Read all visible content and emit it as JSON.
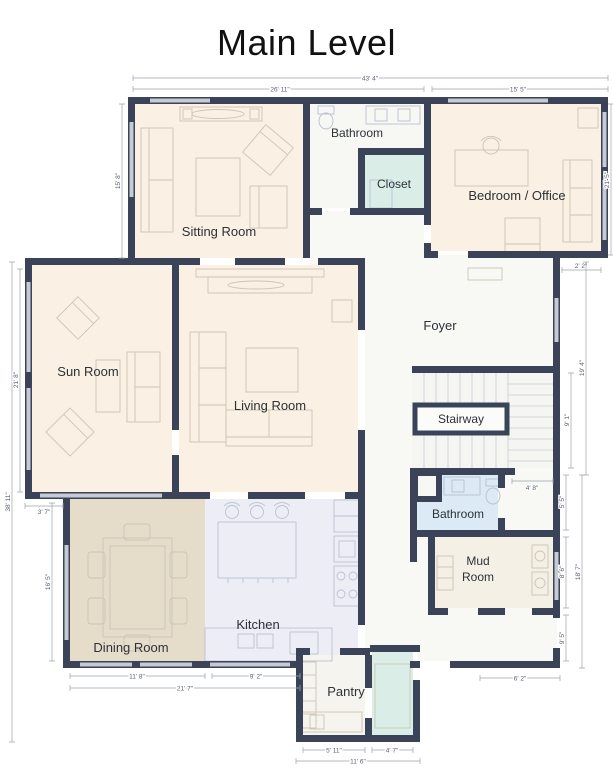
{
  "title": "Main Level",
  "colors": {
    "wall": "#3b4359",
    "room_cream": "#faf0e3",
    "dining_tan": "#e6dcca",
    "kitchen_lavender": "#edeef5",
    "bath_blue": "#dceaf6",
    "closet_teal": "#daeee7",
    "window_gray": "#c6cad2",
    "foyer_white": "#f8f8f5"
  },
  "rooms": {
    "sitting": {
      "label": "Sitting Room"
    },
    "bathroom_top": {
      "label": "Bathroom"
    },
    "closet": {
      "label": "Closet"
    },
    "bedroom_office": {
      "label": "Bedroom / Office"
    },
    "foyer": {
      "label": "Foyer"
    },
    "sun_room": {
      "label": "Sun Room"
    },
    "living_room": {
      "label": "Living Room"
    },
    "stairway": {
      "label": "Stairway"
    },
    "bathroom_lower": {
      "label": "Bathroom"
    },
    "mud_room": {
      "label": "Mud Room",
      "line1": "Mud",
      "line2": "Room"
    },
    "dining_room": {
      "label": "Dining Room"
    },
    "kitchen": {
      "label": "Kitchen"
    },
    "pantry": {
      "label": "Pantry"
    }
  },
  "dims": [
    {
      "label": "43' 4\""
    },
    {
      "label": "26' 11\""
    },
    {
      "label": "15' 5\""
    },
    {
      "label": "15' 8\""
    },
    {
      "label": "38' 11\""
    },
    {
      "label": "21' 8\""
    },
    {
      "label": "3' 7\""
    },
    {
      "label": "16' 5\""
    },
    {
      "label": "11' 8\""
    },
    {
      "label": "9' 2\""
    },
    {
      "label": "21' 7\""
    },
    {
      "label": "5' 11\""
    },
    {
      "label": "4' 7\""
    },
    {
      "label": "11' 6\""
    },
    {
      "label": "2' 2\""
    },
    {
      "label": "19' 4\""
    },
    {
      "label": "9' 1\""
    },
    {
      "label": "4' 8\""
    },
    {
      "label": "5' 5\""
    },
    {
      "label": "8' 6\""
    },
    {
      "label": "18' 7\""
    },
    {
      "label": "6' 2\""
    },
    {
      "label": "9' 5\""
    },
    {
      "label": "21' 5\""
    }
  ]
}
